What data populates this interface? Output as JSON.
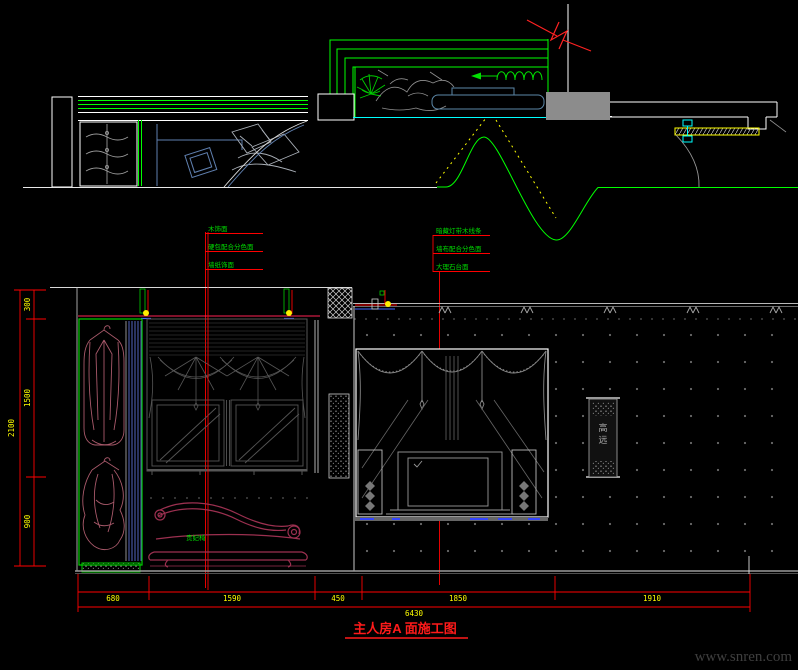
{
  "page": {
    "background": "#000000",
    "watermark": "www.snren.com"
  },
  "title": {
    "text": "主人房A 面施工图"
  },
  "annotations": {
    "left": {
      "line1": "木饰面",
      "line2": "硬包配合分色面",
      "line3": "墙纸饰面"
    },
    "right": {
      "line1": "暗藏灯带木线条",
      "line2": "墙布配合分色面",
      "line3": "大理石台面"
    }
  },
  "labels": {
    "chaise": "贵妃椅",
    "scroll_char1": "高",
    "scroll_char2": "远"
  },
  "dimensions": {
    "bottom": {
      "d1": "680",
      "d2": "1590",
      "d3": "450",
      "d4": "1850",
      "d5": "1910",
      "total": "6430"
    },
    "left": {
      "v1": "300",
      "v2": "1500",
      "v3": "900",
      "total": "2100"
    }
  },
  "colors": {
    "cad_green": "#00ff00",
    "dim_red": "#ff0000",
    "dim_text": "#ffff00",
    "annotation_green": "#00dd00",
    "cyan": "#00ffff",
    "furniture_maroon": "#9c3050",
    "plan_blue": "#6080b0",
    "wall_gray": "#8c8c8c",
    "white": "#ffffff",
    "title_red": "#ff1a1a",
    "watermark_gray": "#3f3f3f"
  }
}
